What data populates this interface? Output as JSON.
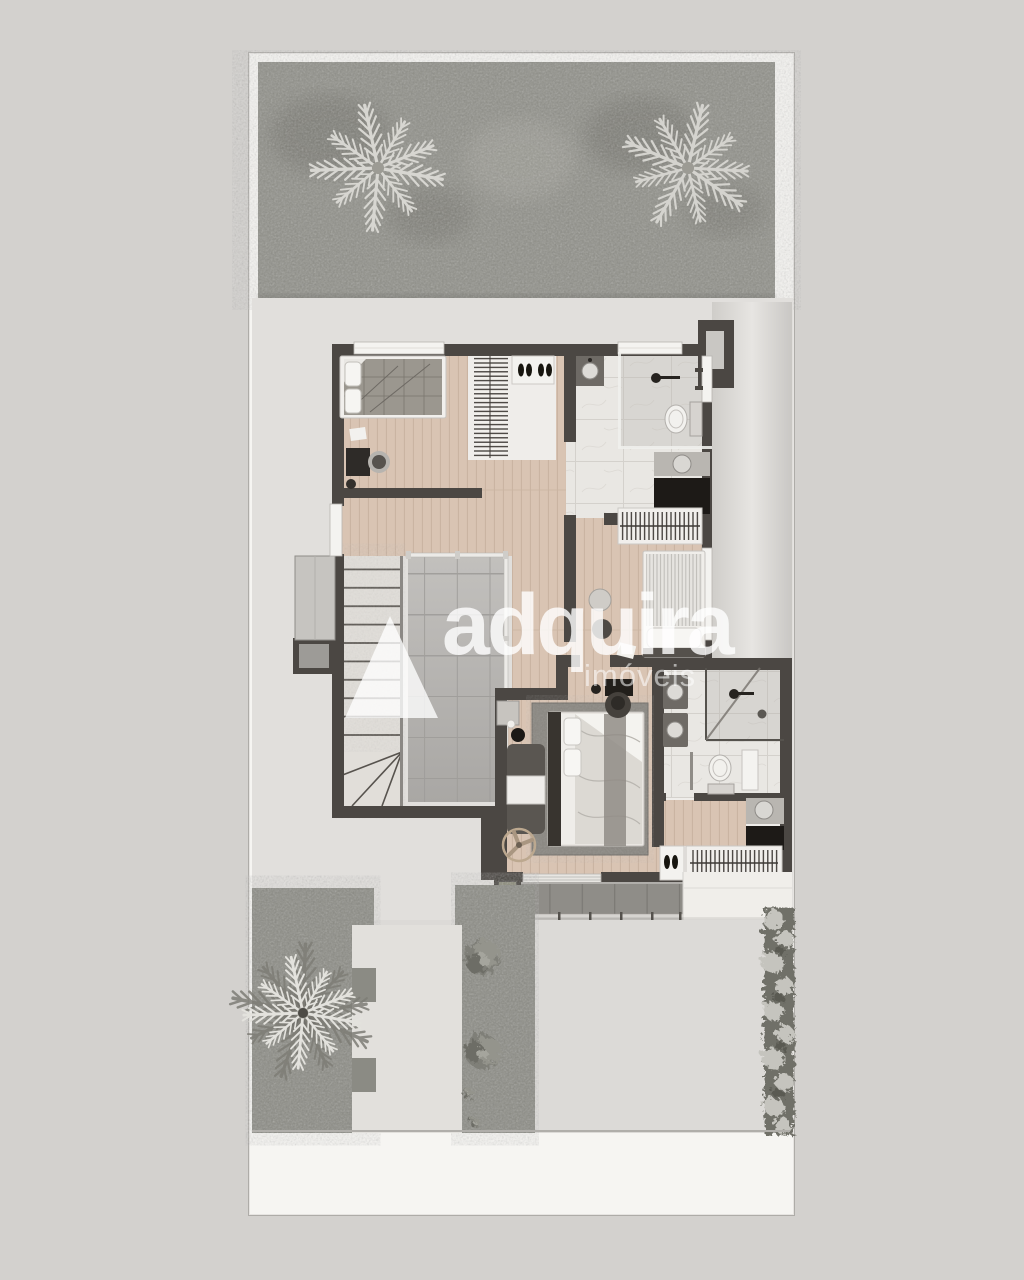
{
  "watermark": {
    "brand": "adquira",
    "suffix": "imóveis",
    "logo_icon": "triangle-logo-icon",
    "color": "#ffffff"
  },
  "palette": {
    "background": "#d3d1ce",
    "lot_sheet": "#f6f5f2",
    "lawn": "#8f8f88",
    "palm_foliage": "#d7d6d1",
    "walls": "#4b4743",
    "wood_floor": "#d9c4b3",
    "marble_floor": "#e9e7e3",
    "skylight_glass": "#b5b3b0",
    "stair_stone": "#e1ded9",
    "deck_concrete": "#8f8d88",
    "paving": "#dcdad7",
    "rug": "#8a8781",
    "furniture_dark": "#1d1a17"
  }
}
